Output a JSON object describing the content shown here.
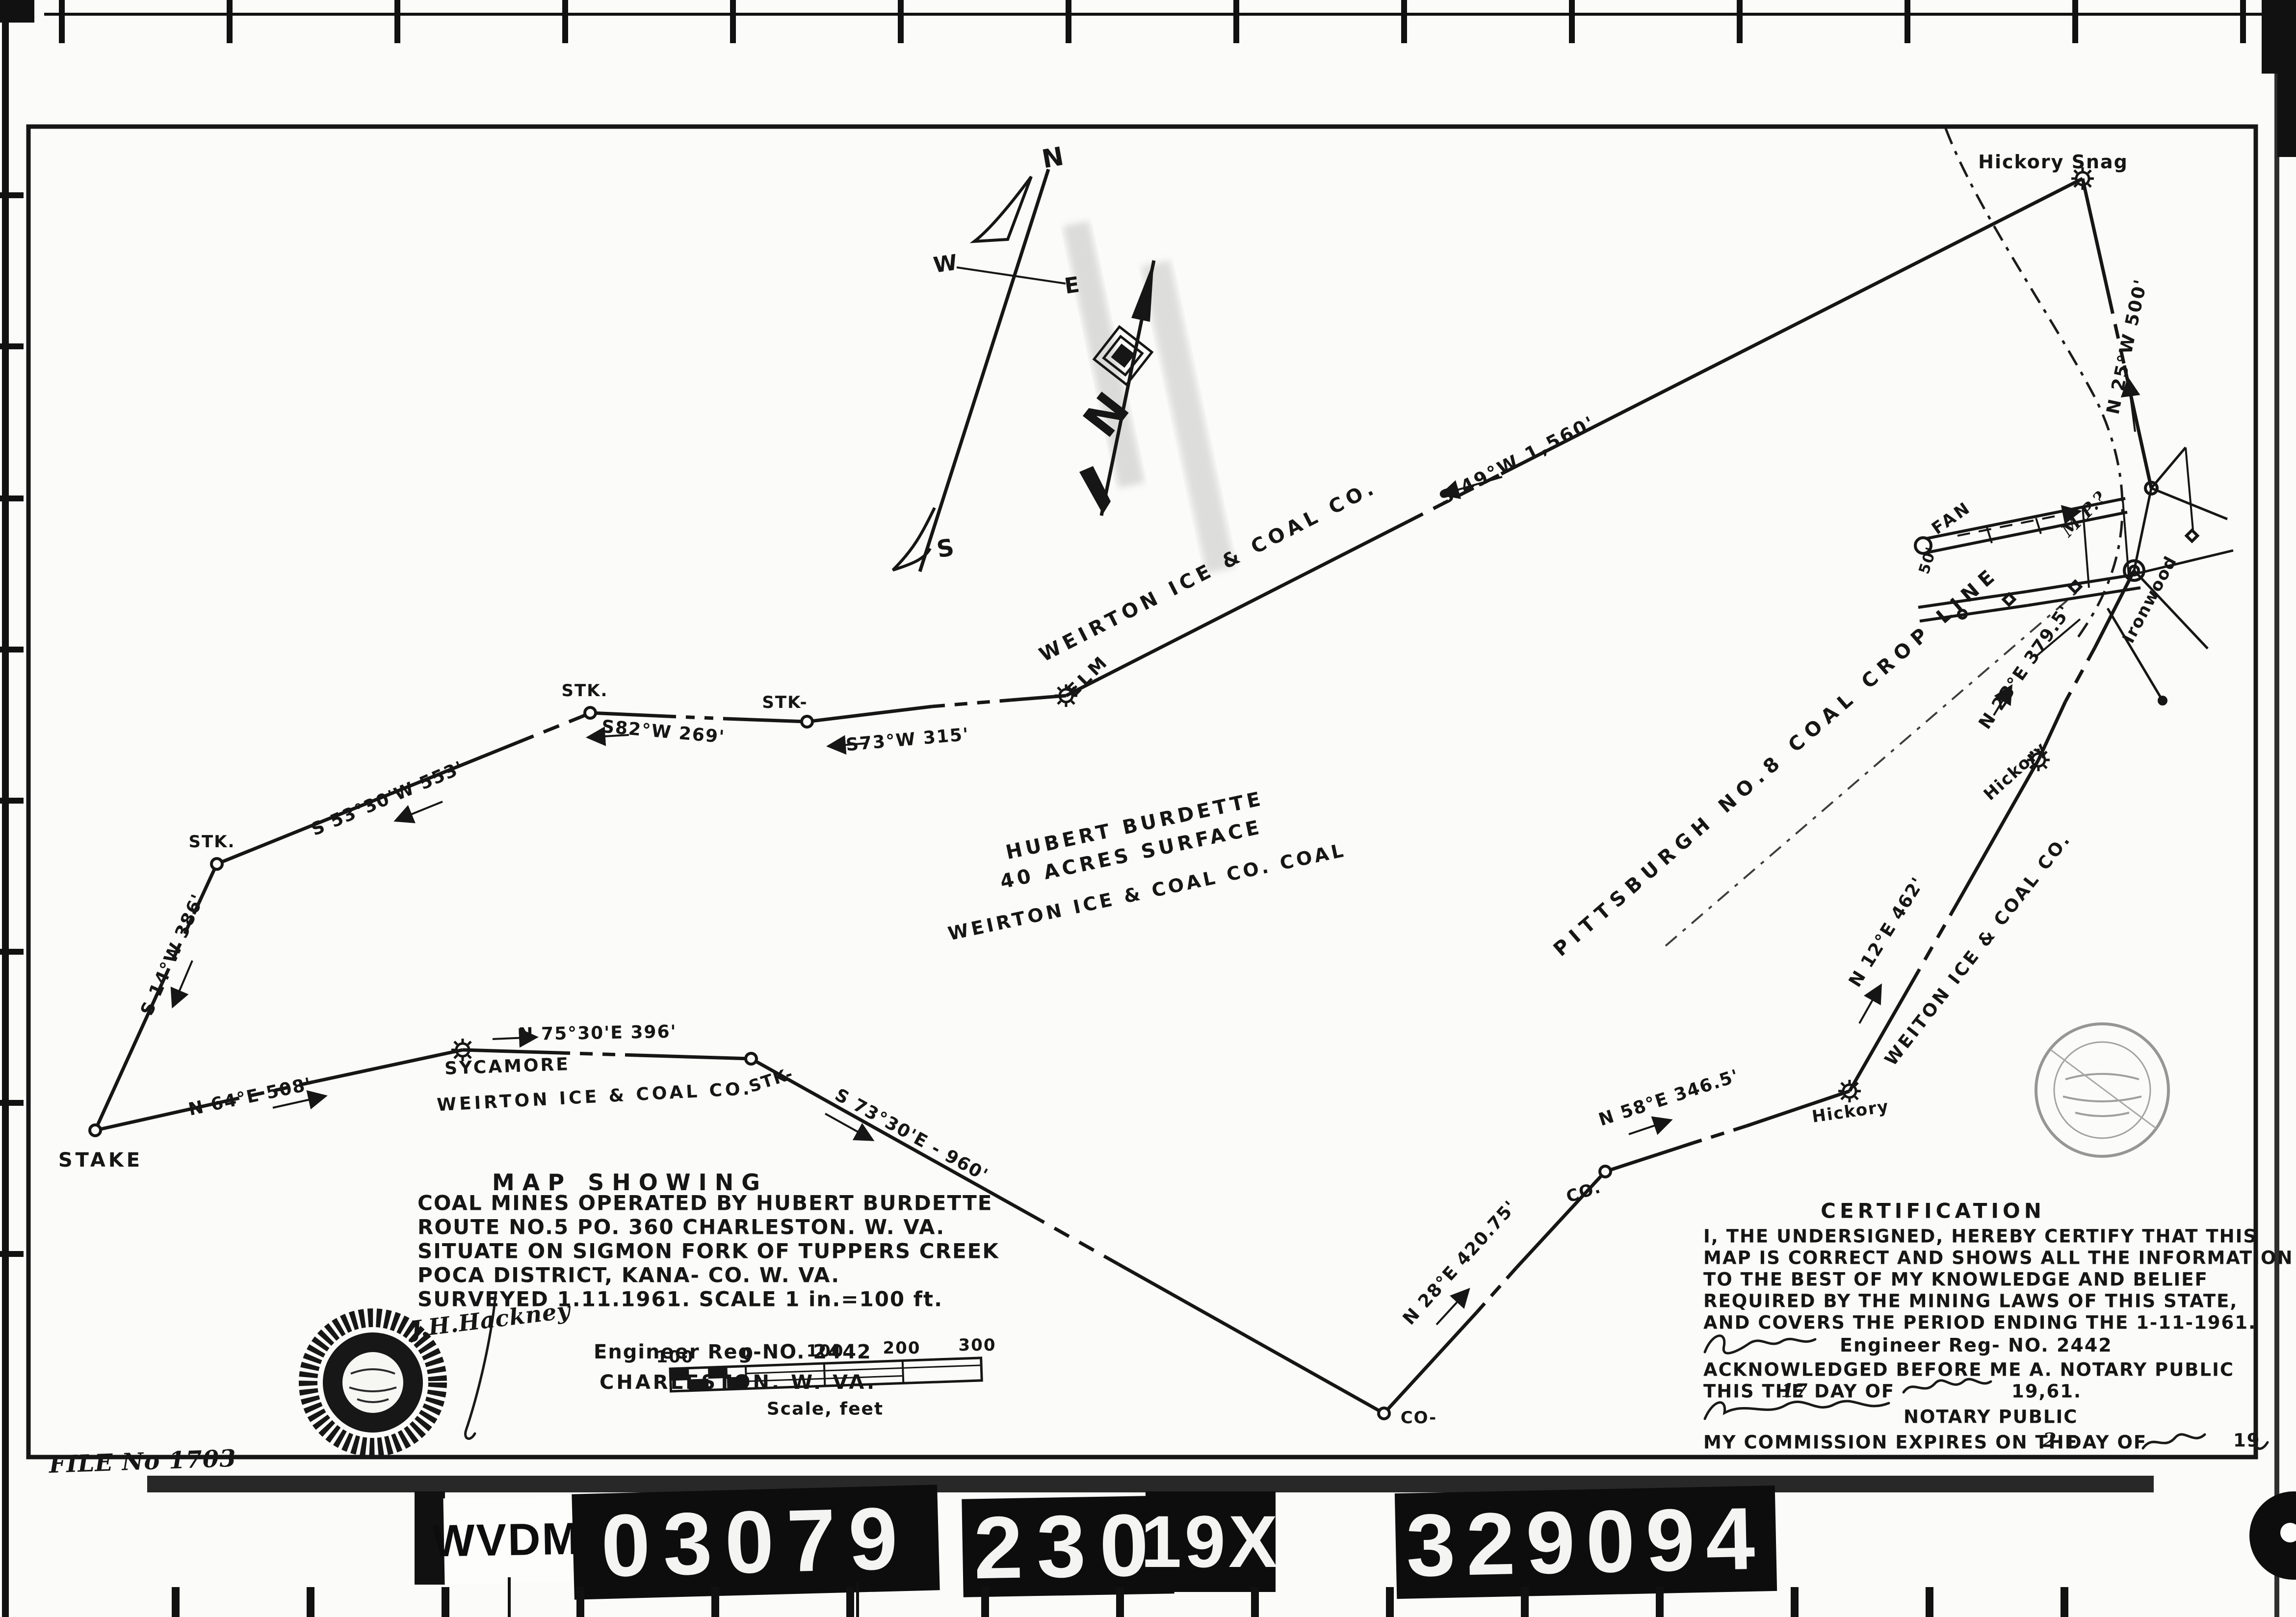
{
  "sheet": {
    "file_no": "FILE No 1703"
  },
  "film_strip": {
    "agency": "WVDM",
    "reel_number": "03079",
    "frame_number": "230",
    "index_code": "19X",
    "document_number": "329094"
  },
  "compass": {
    "north": "N",
    "south": "S",
    "east": "E",
    "west": "W",
    "needle_letter": "N"
  },
  "tract": {
    "line1": "HUBERT BURDETTE",
    "line2": "40 ACRES SURFACE",
    "line3": "WEIRTON ICE & COAL CO. COAL"
  },
  "companies": {
    "upper": "WEIRTON ICE & COAL CO.",
    "lower": "WEIRTON ICE & COAL CO.",
    "right": "WEITON ICE & COAL CO."
  },
  "crop_line_label": "PITTSBURGH NO.8 COAL CROP LINE",
  "bearings": [
    {
      "label": "S 49°W 1,560'"
    },
    {
      "label": "N 25°W 500'"
    },
    {
      "label": "S73°W 315'"
    },
    {
      "label": "S82°W 269'"
    },
    {
      "label": "S 53°30'W 553'"
    },
    {
      "label": "S 14°W 386'"
    },
    {
      "label": "N 64°E 508'"
    },
    {
      "label": "N 75°30'E 396'"
    },
    {
      "label": "S 73°30'E - 960'"
    },
    {
      "label": "N 28°E 420.75'"
    },
    {
      "label": "N 58°E 346.5'"
    },
    {
      "label": "N 12°E 462'"
    },
    {
      "label": "N 23°E 379.5'"
    }
  ],
  "points": [
    {
      "label": "STAKE"
    },
    {
      "label": "STK."
    },
    {
      "label": "STK."
    },
    {
      "label": "STK-"
    },
    {
      "label": "ELM"
    },
    {
      "label": "Hickory Snag"
    },
    {
      "label": "Ironwood"
    },
    {
      "label": "Hickory"
    },
    {
      "label": "Hickory"
    },
    {
      "label": "CO."
    },
    {
      "label": "CO-"
    },
    {
      "label": "STK-"
    },
    {
      "label": "SYCAMORE"
    },
    {
      "label": "FAN"
    },
    {
      "label": "50'"
    },
    {
      "label": "M.P.?"
    }
  ],
  "title_block": {
    "heading": "MAP SHOWING",
    "line1": "COAL MINES OPERATED BY HUBERT BURDETTE",
    "line2": "ROUTE NO.5 PO. 360 CHARLESTON. W. VA.",
    "line3": "SITUATE ON SIGMON FORK OF TUPPERS CREEK",
    "line4": "POCA DISTRICT, KANA- CO. W. VA.",
    "line5": "SURVEYED 1.11.1961. SCALE 1 in.=100 ft.",
    "signature": "J.H.Hackney",
    "engineer_line": "Engineer Reg-NO. 2442",
    "city_line": "CHARLESTON. W. VA."
  },
  "scale_bar": {
    "tick0": "100",
    "tick1": "0",
    "tick2": "100",
    "tick3": "200",
    "tick4": "300",
    "caption": "Scale, feet"
  },
  "certification": {
    "heading": "CERTIFICATION",
    "body1": "I, THE UNDERSIGNED, HEREBY CERTIFY THAT THIS",
    "body2": "MAP IS CORRECT AND SHOWS ALL THE INFORMATION",
    "body3": "TO THE BEST OF MY KNOWLEDGE AND BELIEF",
    "body4": "REQUIRED BY THE MINING LAWS OF THIS STATE,",
    "body5": "AND COVERS THE PERIOD ENDING THE 1-11-1961.",
    "engineer_line": "Engineer Reg- NO. 2442",
    "acknowledged": "ACKNOWLEDGED BEFORE ME A. NOTARY PUBLIC",
    "this_the": "THIS THE",
    "day": "17",
    "day_of": "DAY OF",
    "year": "19,61.",
    "notary_label": "NOTARY PUBLIC",
    "commission_pre": "MY COMMISSION EXPIRES ON THE",
    "commission_day": "2",
    "commission_mid": "DAY OF",
    "commission_year": "19"
  }
}
